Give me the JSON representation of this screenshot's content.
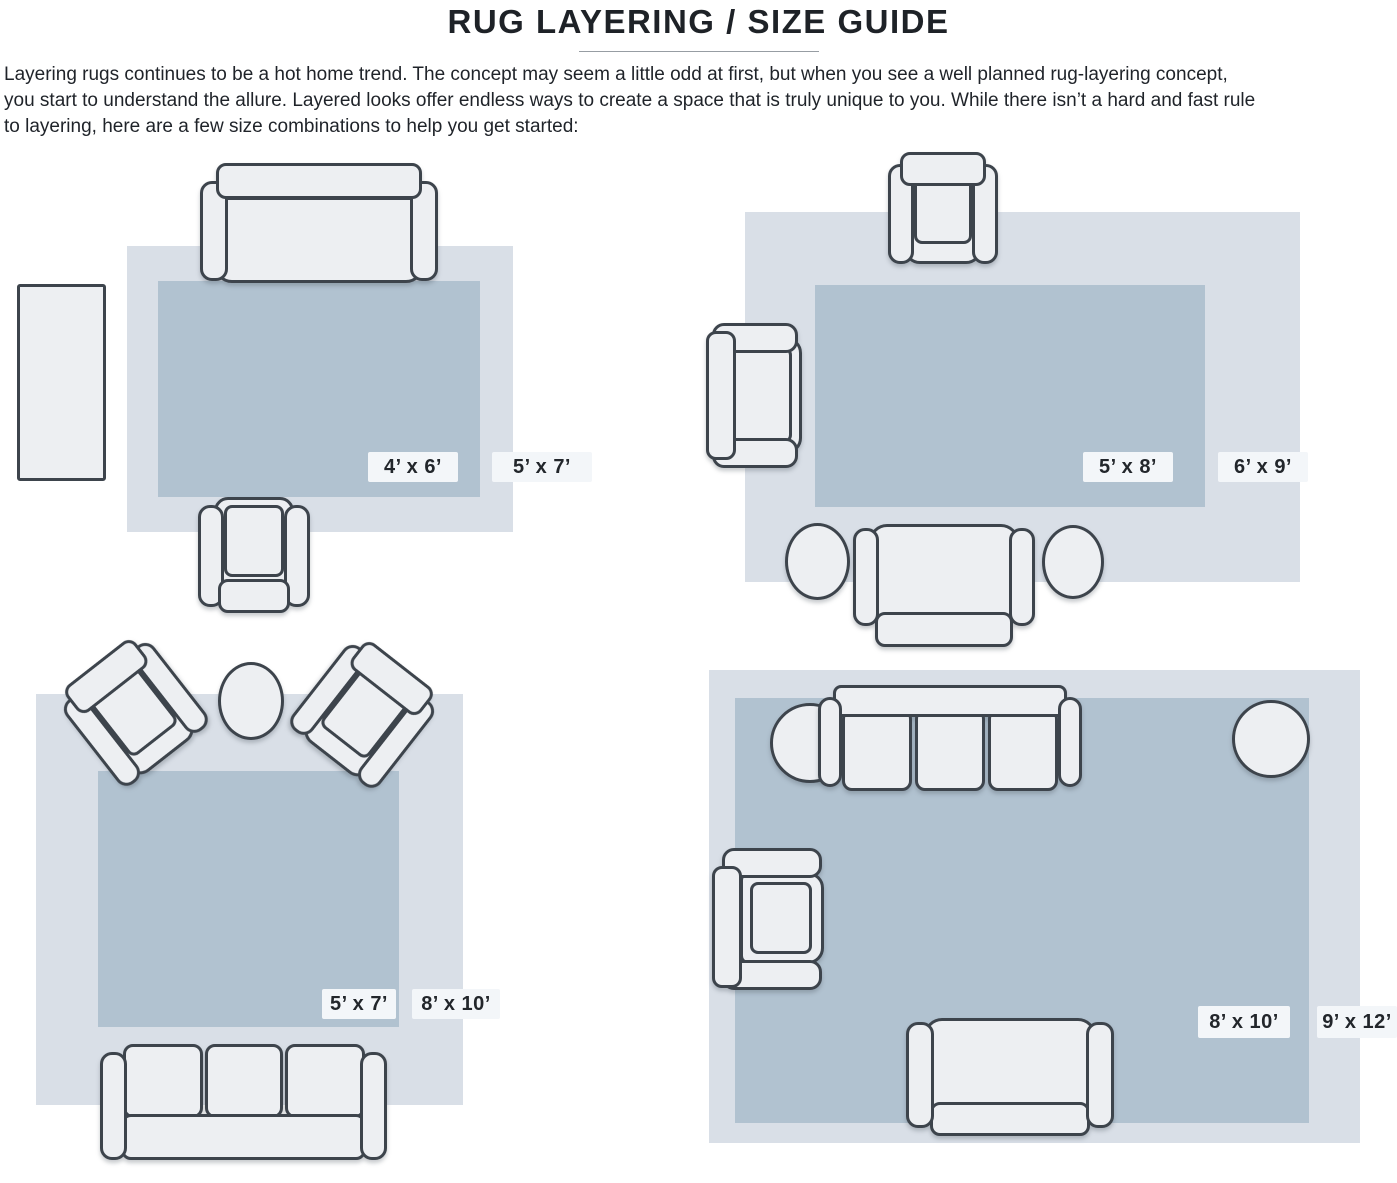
{
  "title": "RUG LAYERING / SIZE GUIDE",
  "intro_lines": [
    "Layering rugs continues to be a hot home trend. The concept may seem a little odd at first, but when you see a well planned rug-layering concept,",
    "you start to understand the allure. Layered looks offer endless ways to create a space that is truly unique to you. While there isn’t a hard and fast rule",
    "to layering, here are a few size combinations to help you get started:"
  ],
  "colors": {
    "outer_rug": "#d9dfe7",
    "inner_rug": "#b1c2d0",
    "furniture_fill": "#edeff2",
    "outline": "#3d444c",
    "label_bg": "#f3f6f9",
    "label_text": "#22262b"
  },
  "diagrams": [
    {
      "id": "layout-5x7-over-4x6",
      "inner_label": "4’ x 6’",
      "outer_label": "5’ x 7’"
    },
    {
      "id": "layout-6x9-over-5x8",
      "inner_label": "5’ x 8’",
      "outer_label": "6’ x 9’"
    },
    {
      "id": "layout-8x10-over-5x7",
      "inner_label": "5’ x 7’",
      "outer_label": "8’ x 10’"
    },
    {
      "id": "layout-9x12-over-8x10",
      "inner_label": "8’ x 10’",
      "outer_label": "9’ x 12’"
    }
  ]
}
